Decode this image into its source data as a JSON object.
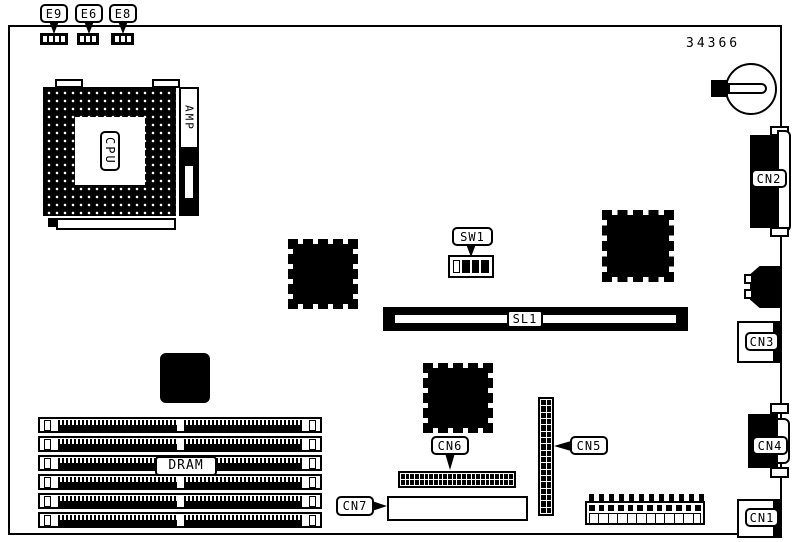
{
  "part_number": "34366",
  "jumpers": [
    {
      "label": "E9",
      "pins": 4
    },
    {
      "label": "E6",
      "pins": 3
    },
    {
      "label": "E8",
      "pins": 3
    }
  ],
  "cpu": {
    "socket_label": "CPU",
    "bracket_label": "AMP"
  },
  "switch": {
    "label": "SW1",
    "positions": [
      "off",
      "on",
      "on",
      "on"
    ]
  },
  "slot": {
    "label": "SL1"
  },
  "dram": {
    "label": "DRAM",
    "slot_count": 6
  },
  "connectors": {
    "cn1": {
      "label": "CN1"
    },
    "cn2": {
      "label": "CN2"
    },
    "cn3": {
      "label": "CN3"
    },
    "cn4": {
      "label": "CN4"
    },
    "cn5": {
      "label": "CN5",
      "rows": 18,
      "cols": 2
    },
    "cn6": {
      "label": "CN6",
      "rows": 2,
      "cols": 24
    },
    "cn7": {
      "label": "CN7"
    }
  },
  "power_connector": {
    "pins": 12
  },
  "colors": {
    "ink": "#000000",
    "paper": "#ffffff"
  }
}
